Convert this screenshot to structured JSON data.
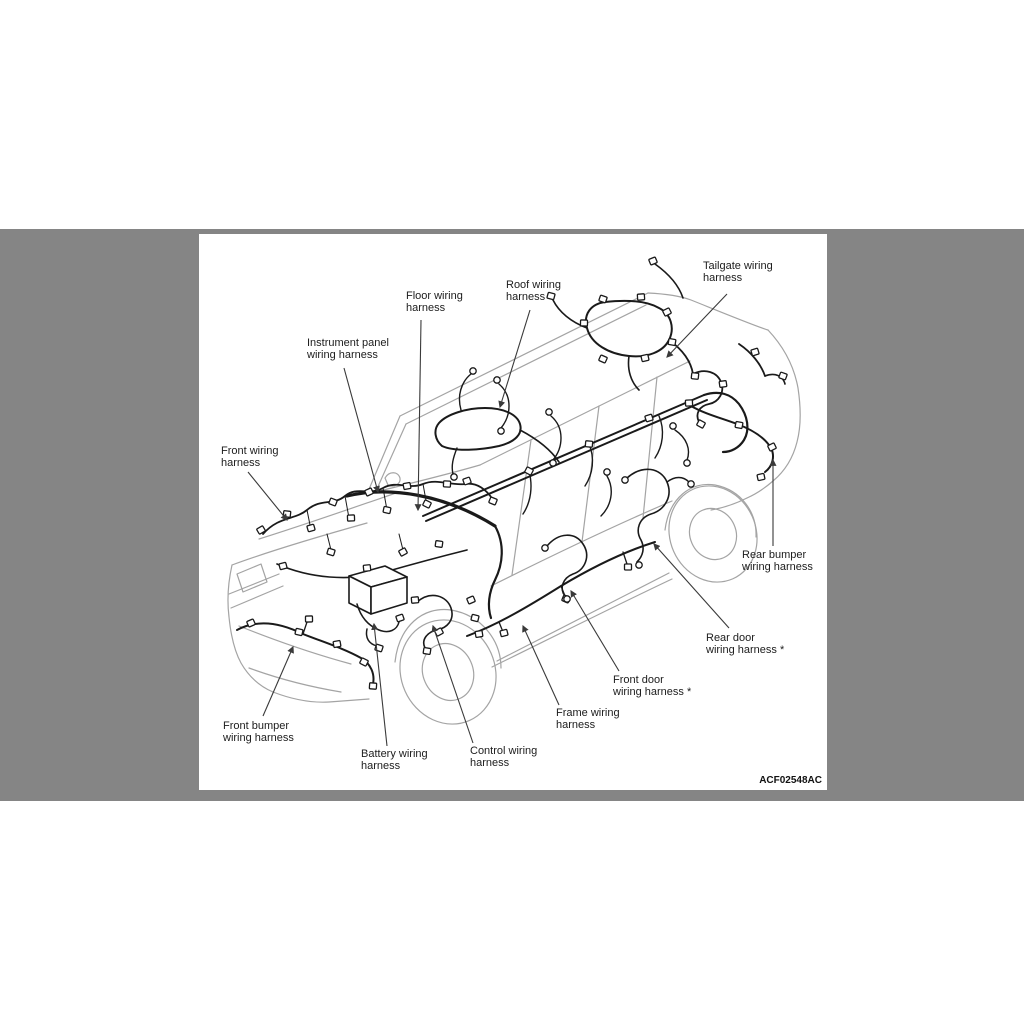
{
  "scene": {
    "page_bg": "#ffffff",
    "band_color": "#858585",
    "panel_bg": "#ffffff",
    "body_line_color": "#a4a4a4",
    "harness_color": "#1a1a1a",
    "leader_color": "#3a3a3a",
    "text_color": "#1c1c1c"
  },
  "diagram": {
    "figure_code": "ACF02548AC",
    "labels": [
      {
        "id": "tailgate",
        "text": "Tailgate wiring\nharness"
      },
      {
        "id": "roof",
        "text": "Roof wiring\nharness"
      },
      {
        "id": "floor",
        "text": "Floor wiring\nharness"
      },
      {
        "id": "instrument-panel",
        "text": "Instrument panel\nwiring harness"
      },
      {
        "id": "front",
        "text": "Front wiring\nharness"
      },
      {
        "id": "rear-bumper",
        "text": "Rear bumper\nwiring harness"
      },
      {
        "id": "rear-door",
        "text": "Rear door\nwiring harness *"
      },
      {
        "id": "front-door",
        "text": "Front door\nwiring harness *"
      },
      {
        "id": "frame",
        "text": "Frame wiring\nharness"
      },
      {
        "id": "front-bumper",
        "text": "Front bumper\nwiring harness"
      },
      {
        "id": "battery",
        "text": "Battery wiring\nharness"
      },
      {
        "id": "control",
        "text": "Control wiring\nharness"
      }
    ]
  }
}
